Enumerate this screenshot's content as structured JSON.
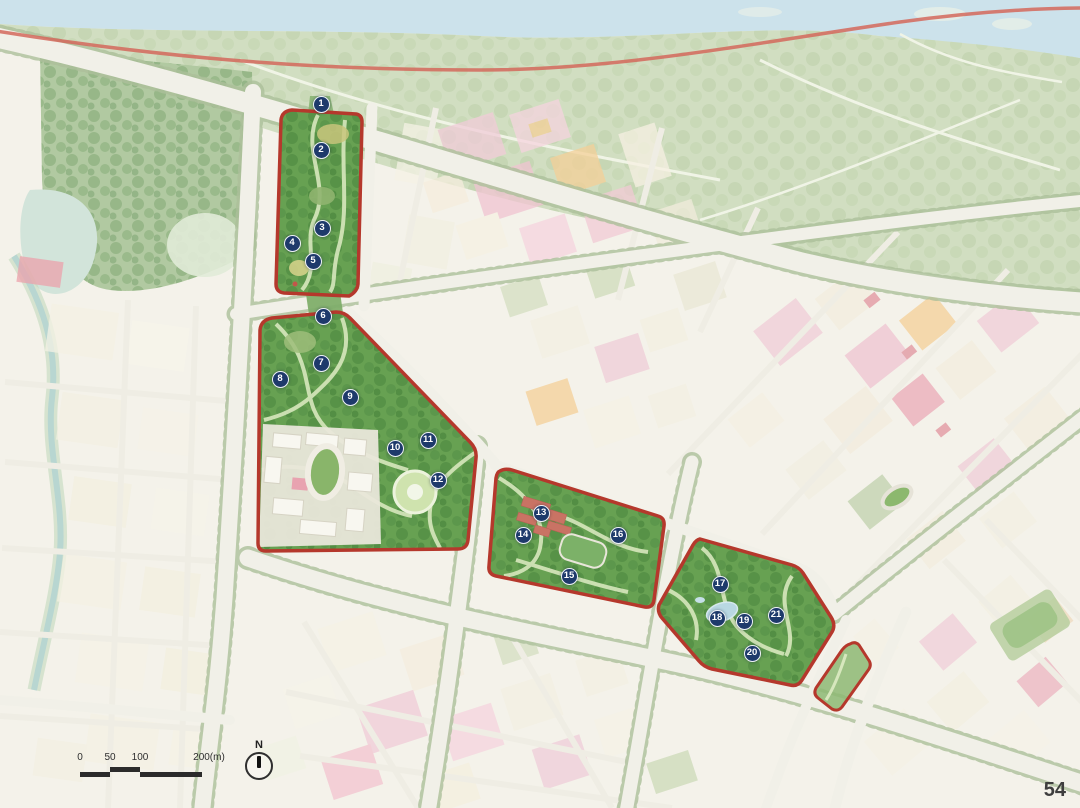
{
  "map": {
    "page_number": "54",
    "north_label": "N",
    "scale_bar": {
      "ticks": [
        "0",
        "50",
        "100",
        "200(m)"
      ]
    },
    "markers": [
      {
        "label": "1",
        "x": 321,
        "y": 104
      },
      {
        "label": "2",
        "x": 321,
        "y": 150
      },
      {
        "label": "3",
        "x": 322,
        "y": 228
      },
      {
        "label": "4",
        "x": 292,
        "y": 243
      },
      {
        "label": "5",
        "x": 313,
        "y": 261
      },
      {
        "label": "6",
        "x": 323,
        "y": 316
      },
      {
        "label": "7",
        "x": 321,
        "y": 363
      },
      {
        "label": "8",
        "x": 280,
        "y": 379
      },
      {
        "label": "9",
        "x": 350,
        "y": 397
      },
      {
        "label": "10",
        "x": 395,
        "y": 448
      },
      {
        "label": "11",
        "x": 428,
        "y": 440
      },
      {
        "label": "12",
        "x": 438,
        "y": 480
      },
      {
        "label": "13",
        "x": 541,
        "y": 513
      },
      {
        "label": "14",
        "x": 523,
        "y": 535
      },
      {
        "label": "15",
        "x": 569,
        "y": 576
      },
      {
        "label": "16",
        "x": 618,
        "y": 535
      },
      {
        "label": "17",
        "x": 720,
        "y": 584
      },
      {
        "label": "18",
        "x": 717,
        "y": 618
      },
      {
        "label": "19",
        "x": 744,
        "y": 621
      },
      {
        "label": "20",
        "x": 752,
        "y": 653
      },
      {
        "label": "21",
        "x": 776,
        "y": 615
      }
    ],
    "colors": {
      "park_boundary": "#b5382c",
      "marker_badge": "#1e3a6b",
      "park_green": "#67a152",
      "river_blue": "#c3dde8",
      "greenway_red": "#d4695c"
    }
  }
}
